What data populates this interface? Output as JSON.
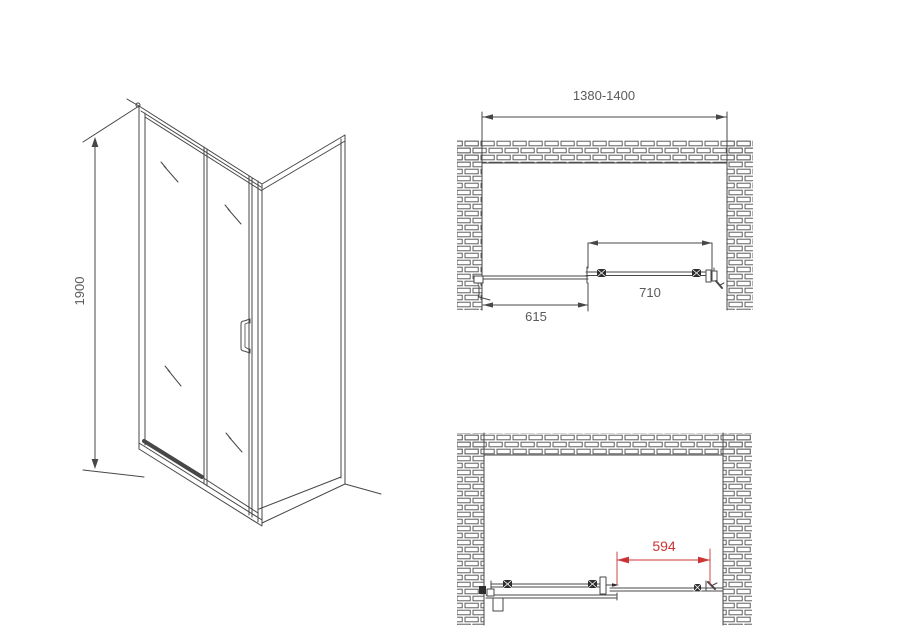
{
  "title": "Shower enclosure installation diagram",
  "colors": {
    "background": "#ffffff",
    "line": "#474747",
    "thin_line": "#6a6a6a",
    "dim_text": "#5a5a5a",
    "red": "#cc3333",
    "dark_fill": "#2e2e2e",
    "brick_line": "#4f4f4f",
    "glass_white": "#ffffff"
  },
  "views": {
    "side_elevation": {
      "height_label": "1900"
    },
    "plan_closed": {
      "overall_width_label": "1380-1400",
      "door_width_label": "710",
      "fixed_panel_width_label": "615"
    },
    "plan_open": {
      "opening_width_label": "594"
    }
  }
}
